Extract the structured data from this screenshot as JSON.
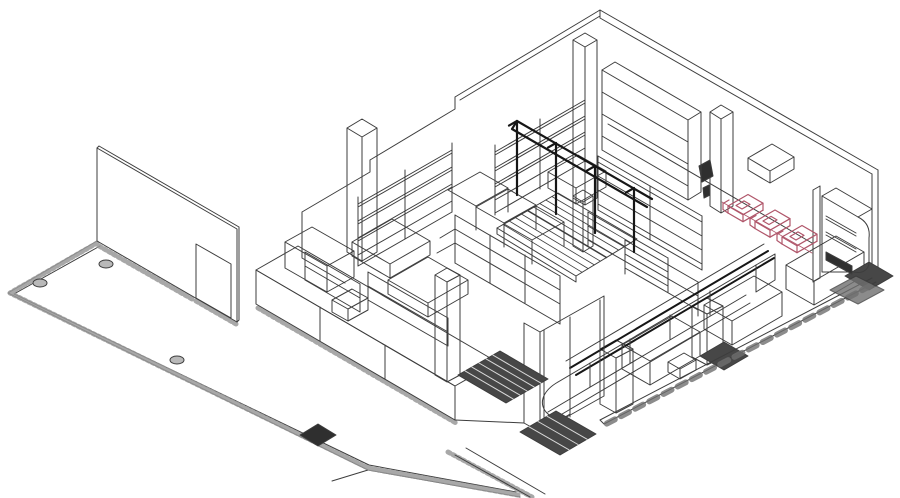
{
  "scene": {
    "colors": {
      "line": "#3d3d3d",
      "heavy": "#161616",
      "cart": "#b0566a",
      "hatch": "#9a9a9a",
      "dark": "#2f2f2f",
      "mat": "#474747",
      "mat_stripe": "#d9d9d9",
      "bollard": "#b9b9b9",
      "shadow": "#6f6f6f",
      "background": "#ffffff"
    },
    "labels": {
      "drawing": "Isometric line drawing of a supermarket interior layout",
      "perimeter_walls": "Perimeter walls",
      "door_wall": "Side wall with door opening",
      "sidewalk": "Hatched sidewalk apron",
      "bollards": "Floor bollards",
      "diamond_mat": "Diamond floor mat",
      "walkin_enclosure": "Walk-in cooler enclosure",
      "backroom_shelving": "Back-room shelving",
      "wall_shelving": "Wall shelving units",
      "wall_cabinet": "Back-wall cabinet shelving",
      "gondolas": "Gondola shelving runs",
      "display_tables": "Open display tables",
      "produce_display": "Sloped produce display with overhead rails",
      "serve_over_case": "Curved refrigerated serve-over counter",
      "checkout_tables": "Checkout stands",
      "columns": "Structural columns",
      "vestibule": "Entrance vestibule",
      "entry_mats": "Entrance floor mats",
      "cooler": "Beverage cooler cabinet",
      "shopping_carts": "Nested shopping carts highlighted in red",
      "front_edge": "Store front edge with shadow hatching"
    }
  }
}
